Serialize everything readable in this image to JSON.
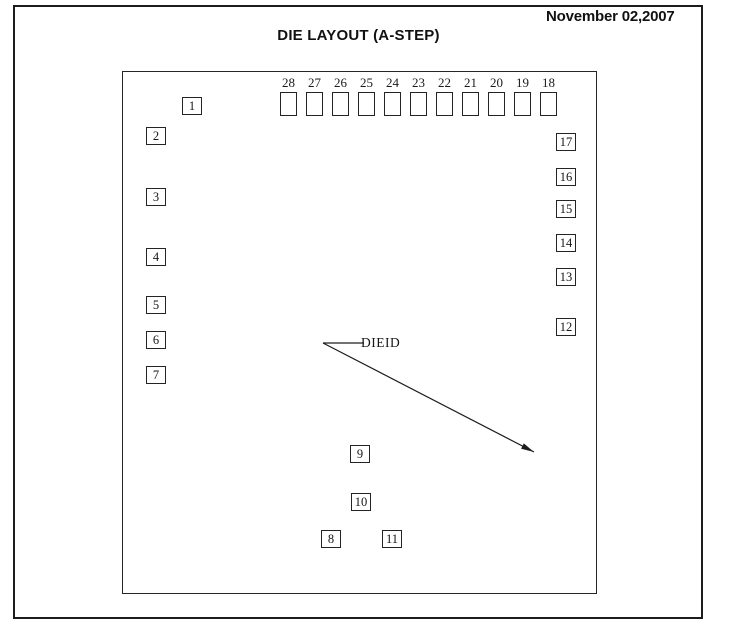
{
  "header": {
    "date": "November 02,2007",
    "title": "DIE LAYOUT (A-STEP)"
  },
  "die_layout": {
    "dieid_label": "DIEID",
    "top_pads": [
      "28",
      "27",
      "26",
      "25",
      "24",
      "23",
      "22",
      "21",
      "20",
      "19",
      "18"
    ],
    "top_row_start_x": 157,
    "top_row_pitch": 26,
    "top_row_y": 3,
    "numbered_pads": [
      {
        "label": "1",
        "x": 59,
        "y": 25
      },
      {
        "label": "2",
        "x": 23,
        "y": 55
      },
      {
        "label": "3",
        "x": 23,
        "y": 116
      },
      {
        "label": "4",
        "x": 23,
        "y": 176
      },
      {
        "label": "5",
        "x": 23,
        "y": 224
      },
      {
        "label": "6",
        "x": 23,
        "y": 259
      },
      {
        "label": "7",
        "x": 23,
        "y": 294
      },
      {
        "label": "17",
        "x": 433,
        "y": 61
      },
      {
        "label": "16",
        "x": 433,
        "y": 96
      },
      {
        "label": "15",
        "x": 433,
        "y": 128
      },
      {
        "label": "14",
        "x": 433,
        "y": 162
      },
      {
        "label": "13",
        "x": 433,
        "y": 196
      },
      {
        "label": "12",
        "x": 433,
        "y": 246
      },
      {
        "label": "9",
        "x": 227,
        "y": 373
      },
      {
        "label": "10",
        "x": 228,
        "y": 421
      },
      {
        "label": "8",
        "x": 198,
        "y": 458
      },
      {
        "label": "11",
        "x": 259,
        "y": 458
      }
    ],
    "callout": {
      "label_x": 238,
      "label_y": 263,
      "leader_from": {
        "x": 241,
        "y": 271
      },
      "vertex": {
        "x": 200,
        "y": 271
      },
      "arrow_tip": {
        "x": 411,
        "y": 380
      }
    },
    "colors": {
      "line": "#1d1d1d",
      "text": "#161616"
    }
  }
}
